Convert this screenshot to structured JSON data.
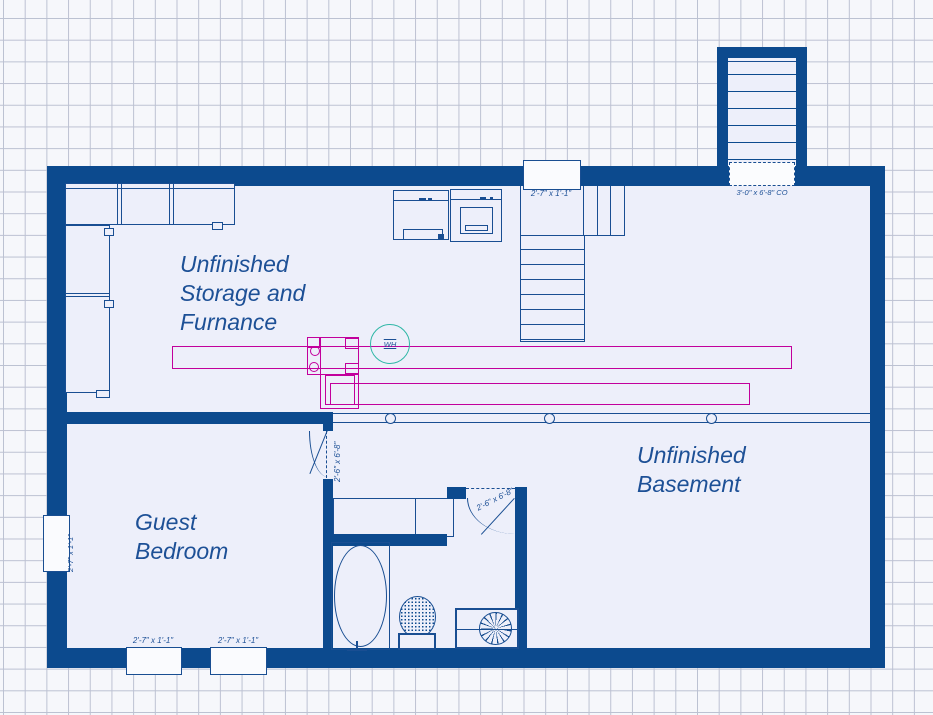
{
  "colors": {
    "wall": "#0c4a8e",
    "line": "#194e92",
    "room_fill": "#edeffa",
    "page_bg": "#f6f7fb",
    "grid_line": "#bcc1d2",
    "duct_magenta": "#c2009c",
    "water_heater_teal": "#2fb7a6",
    "label_text": "#1d5096"
  },
  "rooms": {
    "storage": {
      "label": "Unfinished\nStorage and\nFurnance"
    },
    "bedroom": {
      "label": "Guest\nBedroom"
    },
    "basement": {
      "label": "Unfinished\nBasement"
    }
  },
  "openings": {
    "stair_window": {
      "label": "2'-7\" x 1'-1\""
    },
    "bulkhead_opening": {
      "label": "3'-0\" x 6'-8\" CO"
    },
    "bedroom_left_window": {
      "label": "2'-7\" x 1'-1\""
    },
    "bedroom_bottom_window_1": {
      "label": "2'-7\" x 1'-1\""
    },
    "bedroom_bottom_window_2": {
      "label": "2'-7\" x 1'-1\""
    },
    "bedroom_door": {
      "label": "2'-6\" x 6'-8\""
    },
    "bathroom_door": {
      "label": "2'-6\" x 6'-8\""
    }
  },
  "equipment": {
    "water_heater": {
      "label": "WH"
    }
  }
}
